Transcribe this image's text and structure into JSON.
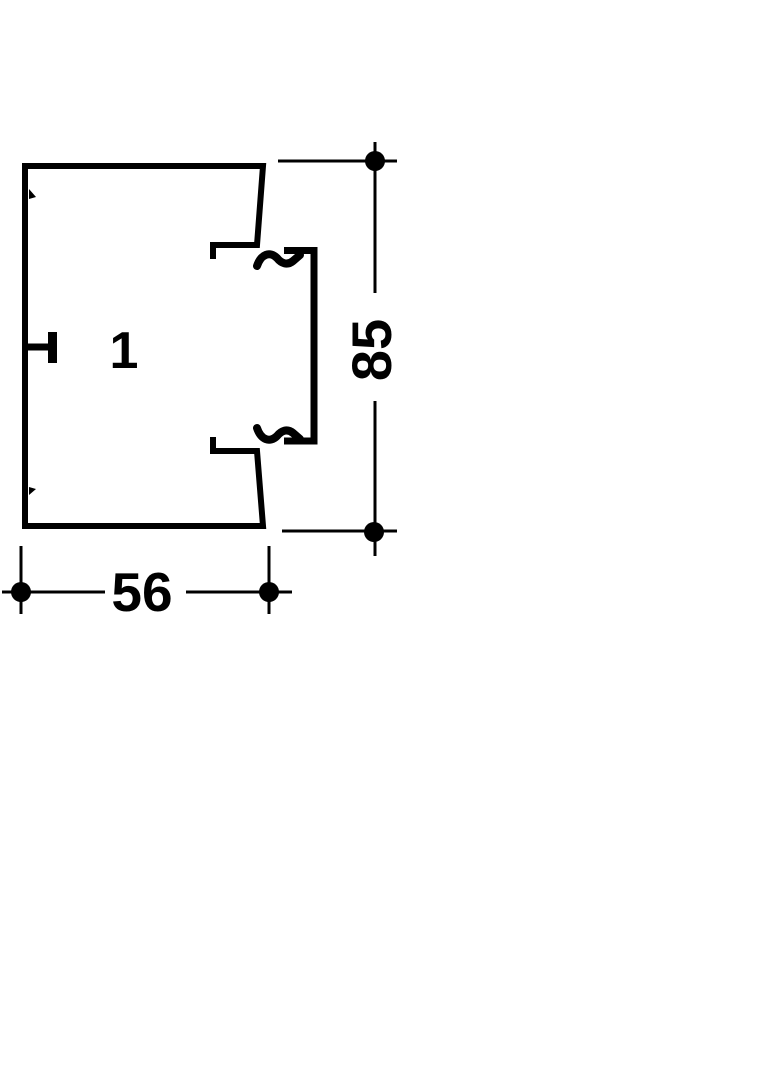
{
  "diagram": {
    "description": "Technical cross-section drawing of a cable trunking profile with cover channel",
    "section_label": "1",
    "dimensions": {
      "width": "56",
      "height": "85"
    },
    "colors": {
      "line": "#000000",
      "background": "#ffffff"
    }
  }
}
